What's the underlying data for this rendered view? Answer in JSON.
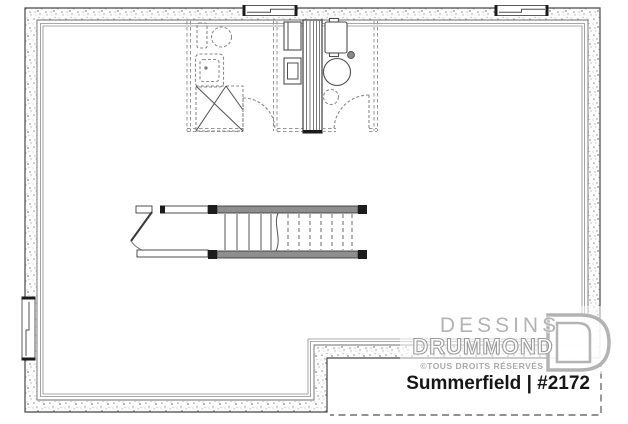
{
  "document": {
    "type": "basement-floor-plan",
    "view": "unfinished basement with future bathroom, mechanical area and central staircase"
  },
  "watermark": {
    "brand_line1": "DESSINS",
    "brand_line2": "DRUMMOND",
    "rights_notice": "©TOUS DROITS RÉSERVÉS"
  },
  "plan_label": {
    "text": "Summerfield | #2172",
    "name": "Summerfield",
    "number": "#2172"
  },
  "colors": {
    "background": "#ffffff",
    "wall_stroke": "#474747",
    "stipple": "#8f8f8f",
    "dashed_future": "#949494",
    "fixture_stroke": "#8a8a8a",
    "stair_wall_fill": "#8e8e8e",
    "watermark_gray": "#b3b3b3",
    "label_color": "#161616"
  },
  "features": [
    "foundation-walls-stippled",
    "basement-window-top-left",
    "basement-window-top-right",
    "basement-window-left-wall",
    "future-bathroom-dashed-partitions",
    "toilet",
    "sink-vanity",
    "corner-shower",
    "bathroom-door-swing",
    "chimney-duct-chase",
    "electrical-panel",
    "furnace",
    "water-heater",
    "floor-drain",
    "sump-pit-dashed",
    "mechanical-room-door-swing",
    "staircase-up",
    "stair-door",
    "unexcavated-notch-dashed-outline"
  ]
}
